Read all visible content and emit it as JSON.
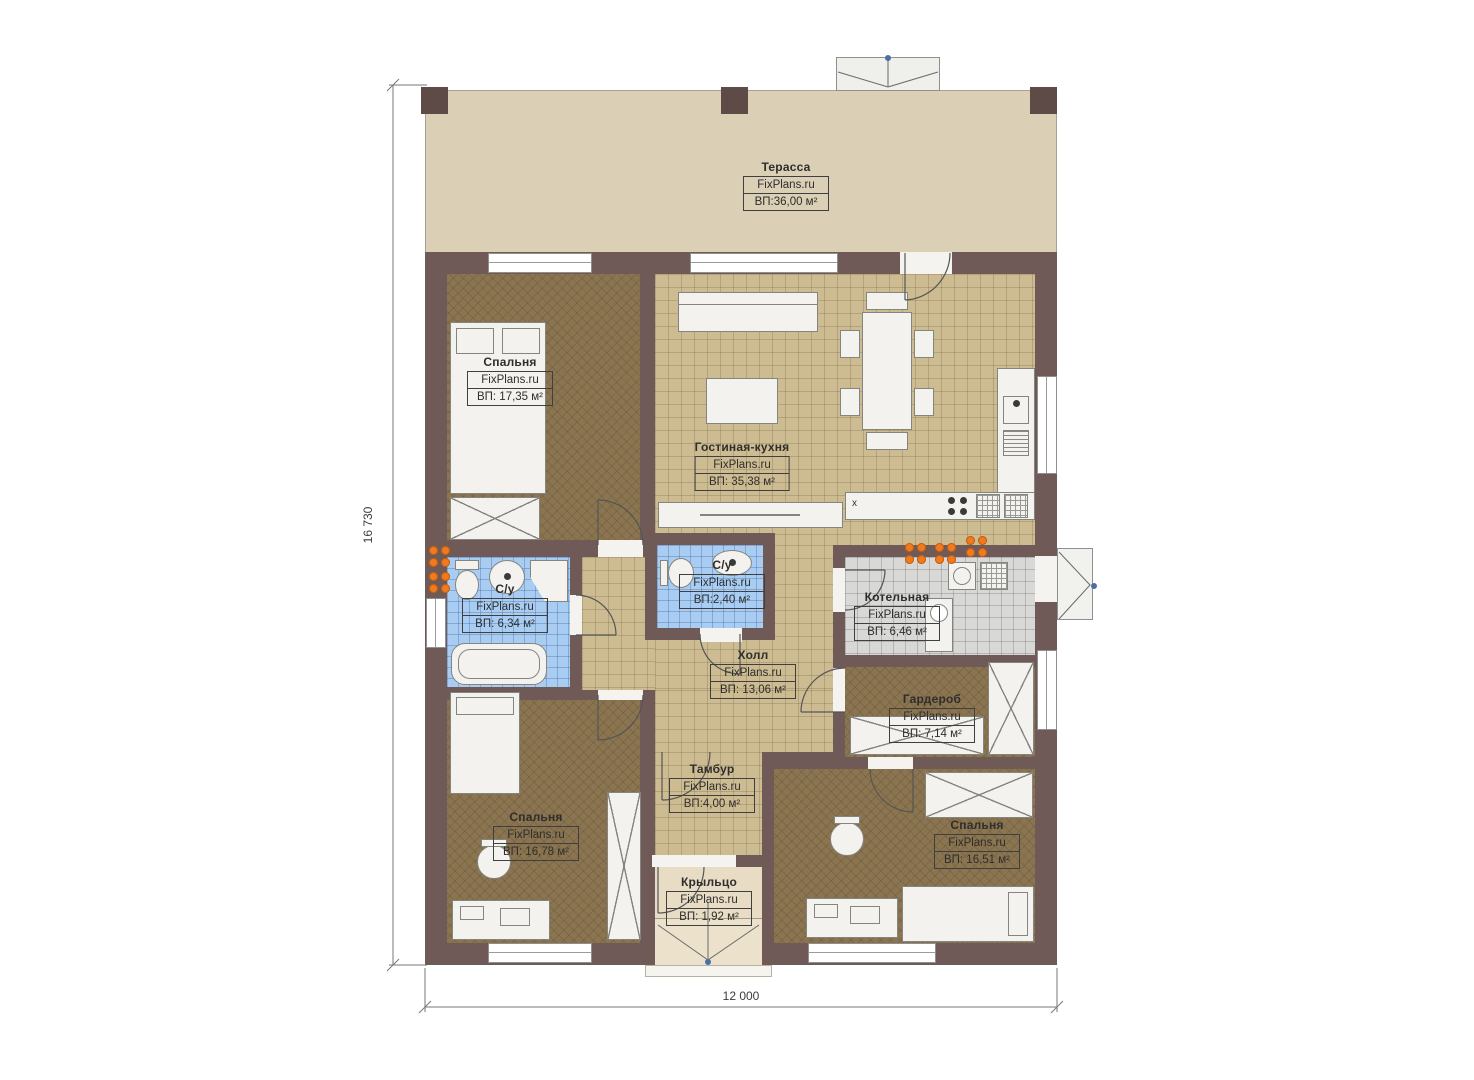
{
  "branding": {
    "watermark": "FixPlans.ru"
  },
  "dimensions": {
    "vertical": "16 730",
    "horizontal": "12 000"
  },
  "annotations": {
    "kitchen_mark": "x"
  },
  "colors": {
    "wall": "#6f5a58",
    "terrace_floor": "#dbcfb6",
    "tile_beige": "#cdbc92",
    "tile_blue": "#a9cdf2",
    "tile_gray": "#d8d8d6",
    "carpet_brown": "#8b7550",
    "porch_floor": "#e8dcc4",
    "furniture": "#f3f2ef",
    "radiator_orange": "#f07a1e"
  },
  "rooms": [
    {
      "id": "terrace",
      "name": "Терасса",
      "area": "ВП:36,00 м²"
    },
    {
      "id": "bedroom-top",
      "name": "Спальня",
      "area": "ВП: 17,35 м²"
    },
    {
      "id": "living-kitchen",
      "name": "Гостиная-кухня",
      "area": "ВП: 35,38 м²"
    },
    {
      "id": "bathroom-main",
      "name": "С/у",
      "area": "ВП: 6,34 м²"
    },
    {
      "id": "bathroom-small",
      "name": "С/у",
      "area": "ВП:2,40 м²"
    },
    {
      "id": "boiler-room",
      "name": "Котельная",
      "area": "ВП: 6,46 м²"
    },
    {
      "id": "hall",
      "name": "Холл",
      "area": "ВП: 13,06 м²"
    },
    {
      "id": "wardrobe-room",
      "name": "Гардероб",
      "area": "ВП: 7,14 м²"
    },
    {
      "id": "vestibule",
      "name": "Тамбур",
      "area": "ВП:4,00 м²"
    },
    {
      "id": "bedroom-left",
      "name": "Спальня",
      "area": "ВП: 16,78 м²"
    },
    {
      "id": "bedroom-right",
      "name": "Спальня",
      "area": "ВП: 16,51 м²"
    },
    {
      "id": "porch",
      "name": "Крыльцо",
      "area": "ВП: 1,92 м²"
    }
  ]
}
